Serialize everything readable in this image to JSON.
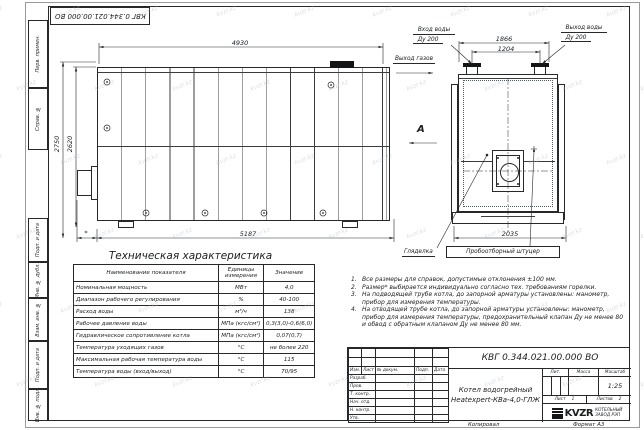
{
  "watermark": {
    "text": "kvzr.kz"
  },
  "frame": {
    "stamp": "КВГ 0.344.021.00.000 ВО",
    "margin_labels": [
      "Перв. примен.",
      "Справ. №",
      "Подп. и дата",
      "Инв. № дубл.",
      "Взам. инв. №",
      "Подп. и дата",
      "Инв. № подл."
    ]
  },
  "front_view": {
    "dim_top": "4930",
    "dim_height_outer": "2750",
    "dim_height_inner": "2620",
    "dim_bottom": "5187",
    "dim_burner": "*",
    "gas_outlet_label": "Выход газов",
    "view_arrow_label": "А"
  },
  "side_view": {
    "water_inlet_label": "Вход воды",
    "water_inlet_dn": "Ду 200",
    "water_outlet_label": "Выход воды",
    "water_outlet_dn": "Ду 200",
    "dim_nozzles_outer": "1866",
    "dim_nozzles_inner": "1204",
    "dim_width": "2035",
    "sight_glass_label": "Гляделка",
    "sampling_fitting_label": "Пробоотборный штуцер"
  },
  "spec_table": {
    "title": "Техническая характеристика",
    "headers": [
      "Наименование показателя",
      "Единицы измерения",
      "Значение"
    ],
    "rows": [
      [
        "Номинальная мощность",
        "МВт",
        "4,0"
      ],
      [
        "Диапазон рабочего регулирования",
        "%",
        "40-100"
      ],
      [
        "Расход воды",
        "м³/ч",
        "138"
      ],
      [
        "Рабочее давление воды",
        "МПа (кгс/см²)",
        "0,3(3,0)-0,6(6,0)"
      ],
      [
        "Гидравлическое сопротивление котла",
        "МПа (кгс/см²)",
        "0,07(0,7)"
      ],
      [
        "Температура уходящих газов",
        "°С",
        "не более 220"
      ],
      [
        "Максимальная рабочая температура воды",
        "°С",
        "115"
      ],
      [
        "Температура воды (вход/выход)",
        "°С",
        "70/95"
      ]
    ]
  },
  "notes": [
    {
      "num": "1.",
      "text": "Все размеры для справок, допустимые отклонения ±100 мм."
    },
    {
      "num": "2.",
      "text": "Размер* выбирается индивидуально согласно тех. требованиям горелки."
    },
    {
      "num": "3.",
      "text": "На подводящей трубе котла, до запорной арматуры установлены: манометр, прибор для измерения температуры."
    },
    {
      "num": "4.",
      "text": "На отводящей трубе котла, до запорной арматуры установлены: манометр, прибор для измерения температуры, предохранительный клапан Ду не менее 80 и обвод с обратным клапаном Ду не менее 80 мм."
    }
  ],
  "title_block": {
    "doc_number": "КВГ 0.344.021.00.000 ВО",
    "product_line1": "Котел водогрейный",
    "product_line2": "Heatexpert-КВа-4,0-ГЛЖ",
    "change_headers": [
      "Изм.",
      "Лист",
      "№ докум.",
      "Подп.",
      "Дата"
    ],
    "role_rows": [
      "Разраб.",
      "Пров.",
      "Т. контр.",
      "Нач. отд.",
      "Н. контр.",
      "Утв."
    ],
    "lit_label": "Лит.",
    "mass_label": "Масса",
    "scale_label": "Масштаб",
    "scale_value": "1:25",
    "sheet_label": "Лист",
    "sheet_value": "1",
    "sheets_label": "Листов",
    "sheets_value": "2",
    "logo_text": "KVZR",
    "logo_sub1": "КОТЕЛЬНЫЙ",
    "logo_sub2": "ЗАВОД РЭП",
    "copied_label": "Копировал",
    "format_label": "Формат А3"
  }
}
